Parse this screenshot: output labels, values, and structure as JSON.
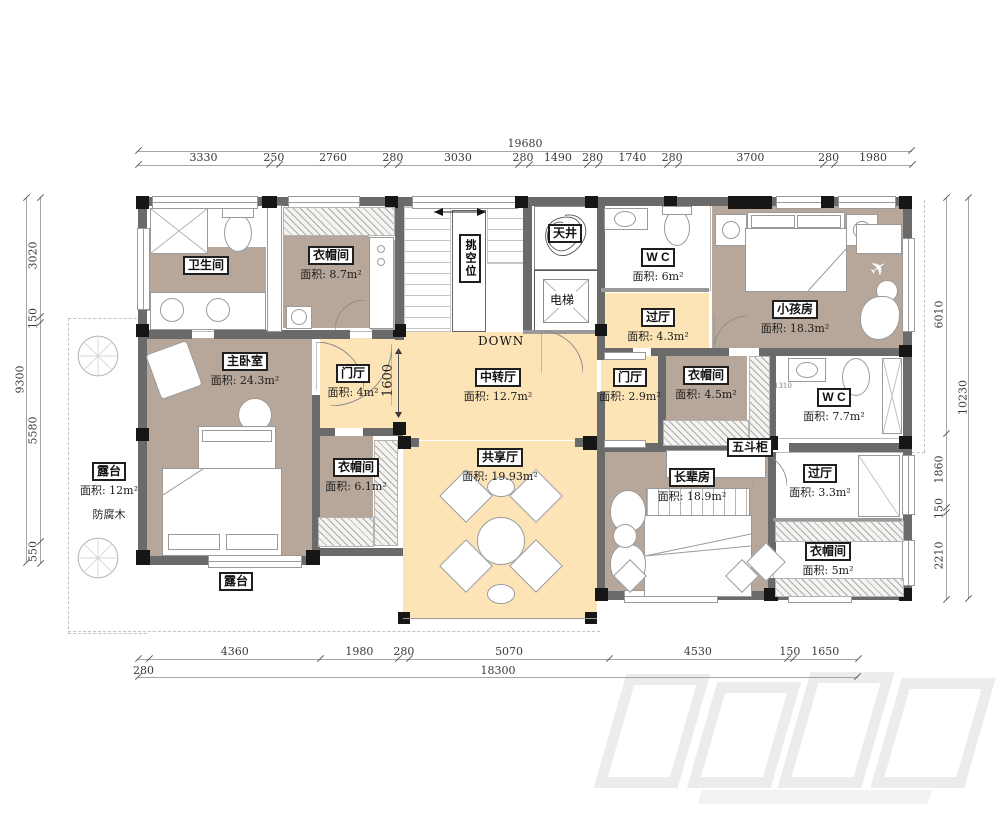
{
  "colors": {
    "room_tan": "#b7a79a",
    "room_cream": "#fce4b6",
    "wall_gray": "#6a6a6a",
    "column_black": "#161616",
    "dim_text": "#3a3a3a"
  },
  "dims": {
    "top_total": "19680",
    "top": [
      "3330",
      "250",
      "2760",
      "280",
      "3030",
      "280",
      "1490",
      "280",
      "1740",
      "280",
      "3700",
      "280",
      "1980"
    ],
    "bottom_total": "18300",
    "bottom": [
      "280",
      "4360",
      "1980",
      "280",
      "5070",
      "4530",
      "150",
      "1650"
    ],
    "left_total": "9300",
    "left": [
      "3020",
      "150",
      "5580",
      "550"
    ],
    "right_total": "10230",
    "right": [
      "6010",
      "1860",
      "150",
      "2210"
    ],
    "door_hall_width": "1600",
    "wc_small_dim": "1310"
  },
  "rooms": {
    "bathroom": {
      "name": "卫生间"
    },
    "cloak_top": {
      "name": "衣帽间",
      "area": "面积: 8.7m²"
    },
    "void": {
      "name": "挑空位"
    },
    "skywell": {
      "name": "天井"
    },
    "elevator": {
      "name": "电梯"
    },
    "wc_top": {
      "name": "W C",
      "area": "面积: 6m²"
    },
    "kids": {
      "name": "小孩房",
      "area": "面积: 18.3m²"
    },
    "hall_top": {
      "name": "过厅",
      "area": "面积: 4.3m²"
    },
    "master": {
      "name": "主卧室",
      "area": "面积: 24.3m²"
    },
    "foyer_master": {
      "name": "门厅",
      "area": "面积: 4m²"
    },
    "transfer": {
      "name": "中转厅",
      "area": "面积: 12.7m²"
    },
    "foyer_small": {
      "name": "门厅",
      "area": "面积: 2.9m²"
    },
    "cloak_mid": {
      "name": "衣帽间",
      "area": "面积: 4.5m²"
    },
    "wc_right": {
      "name": "W C",
      "area": "面积: 7.7m²"
    },
    "terrace_left": {
      "name": "露台",
      "area": "面积: 12m²",
      "note": "防腐木"
    },
    "cloak_master": {
      "name": "衣帽间",
      "area": "面积: 6.1m²"
    },
    "shared": {
      "name": "共享厅",
      "area": "面积: 19.93m²"
    },
    "dresser": {
      "name": "五斗柜"
    },
    "elder": {
      "name": "长辈房",
      "area": "面积: 18.9m²"
    },
    "hall_right": {
      "name": "过厅",
      "area": "面积: 3.3m²"
    },
    "cloak_right": {
      "name": "衣帽间",
      "area": "面积: 5m²"
    },
    "terrace_bottom": {
      "name": "露台"
    }
  },
  "texts": {
    "down": "DOWN"
  }
}
